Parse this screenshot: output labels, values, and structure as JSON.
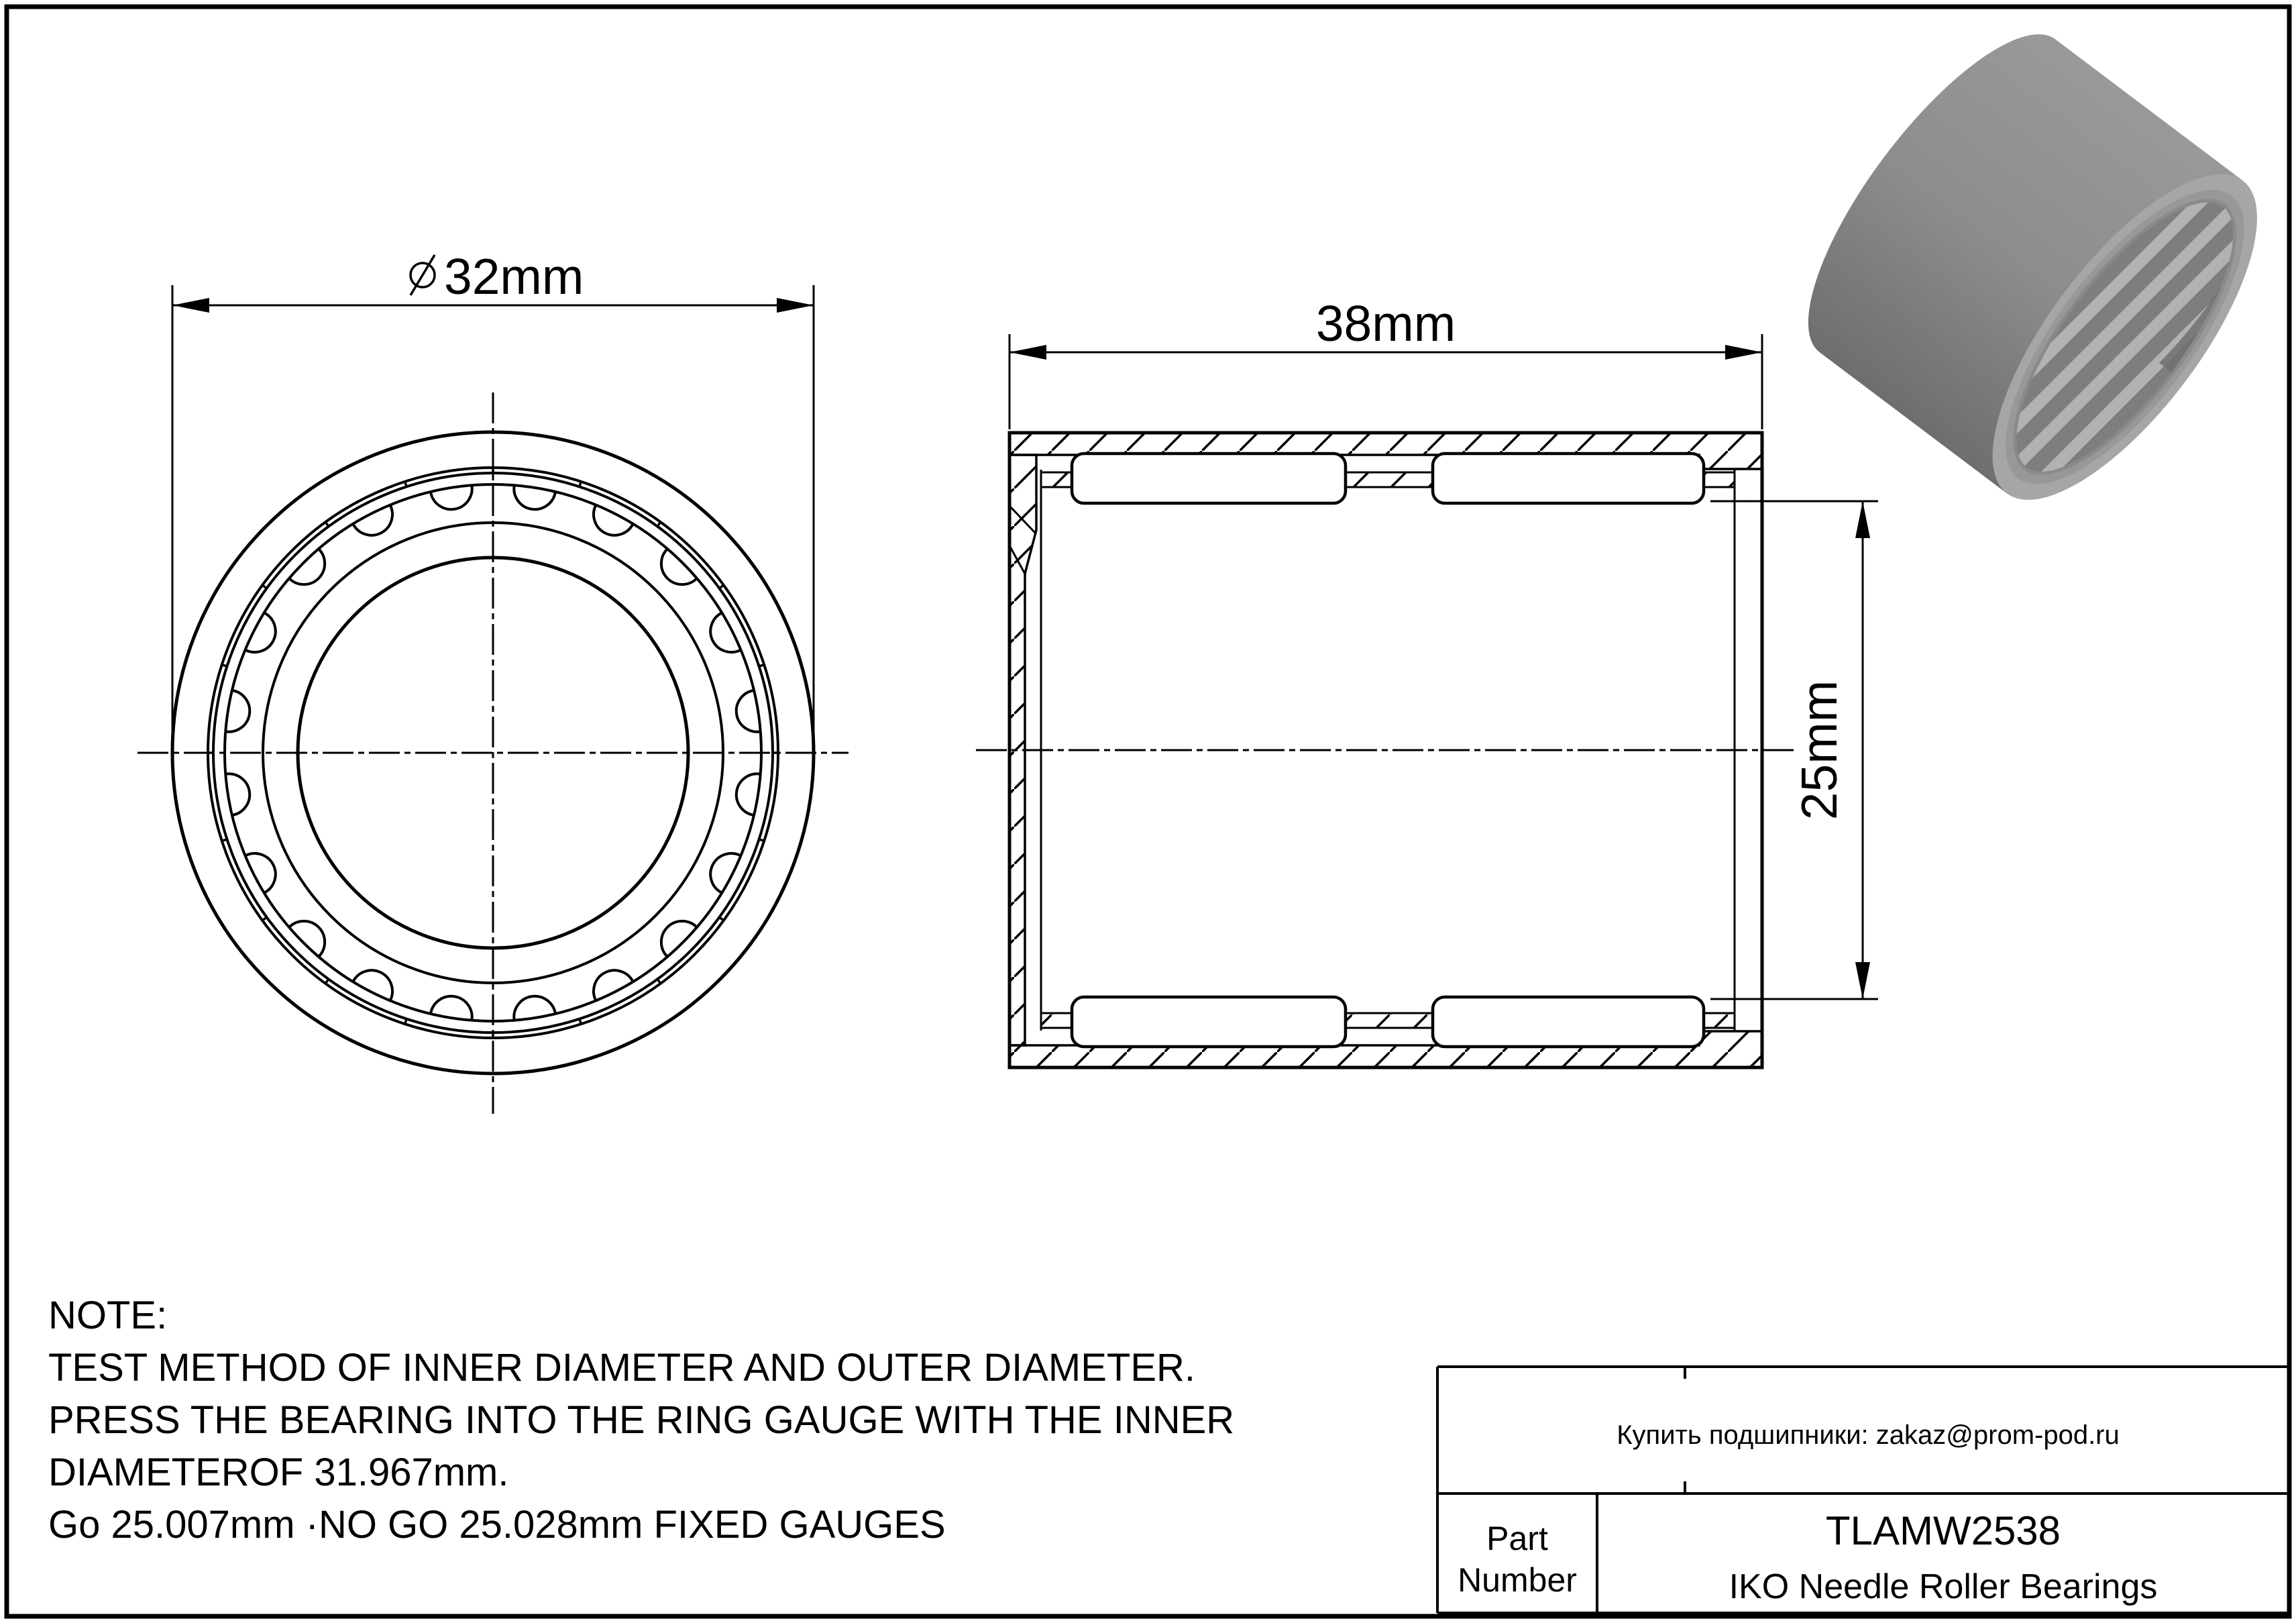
{
  "page": {
    "background_color": "#ffffff",
    "line_color": "#000000"
  },
  "views": {
    "front_view": {
      "description": "front view of needle roller bearing",
      "od_dimension": {
        "symbol": "⌀",
        "value": "32mm"
      }
    },
    "section_view": {
      "description": "cross section of needle roller bearing",
      "width_dimension": "38mm",
      "bore_dimension": "25mm"
    }
  },
  "render_3d": {
    "description": "gray 3d render of shell type needle roller bearing",
    "body_color": "#9a9a9a",
    "shadow_color": "#6e6e6e",
    "highlight_color": "#b9b9b9"
  },
  "note": {
    "line1": "NOTE:",
    "line2": "TEST METHOD OF INNER DIAMETER AND OUTER DIAMETER.",
    "line3": "PRESS THE BEARING INTO THE RING GAUGE WITH THE INNER",
    "line4": "DIAMETEROF 31.967mm.",
    "line5": "Go 25.007mm ·NO GO 25.028mm FIXED GAUGES"
  },
  "title_block": {
    "contact": "Купить подшипники: zakaz@prom-pod.ru",
    "part_label_line1": "Part",
    "part_label_line2": "Number",
    "part_number": "TLAMW2538",
    "part_description": "IKO Needle Roller Bearings"
  }
}
